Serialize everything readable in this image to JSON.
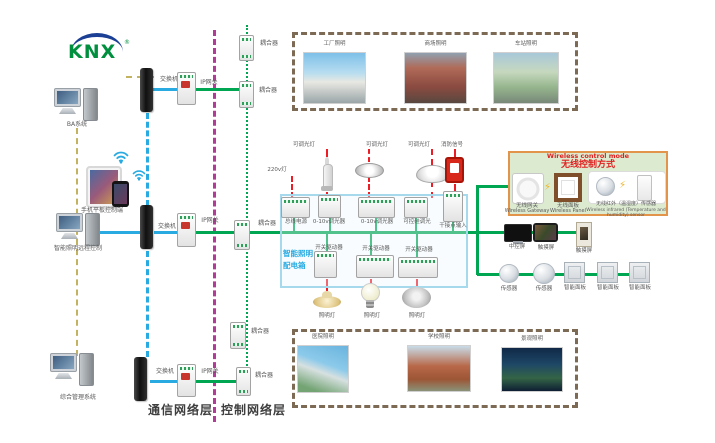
{
  "logo": {
    "text": "KNX",
    "reg": "®"
  },
  "left": {
    "computers": [
      {
        "label": "BA系统"
      },
      {
        "label": "智能照明远程控制"
      },
      {
        "label": "综合管理系统"
      }
    ],
    "mobile_label": "手机平板控制端"
  },
  "network": {
    "switches": [
      "交换机",
      "交换机",
      "交换机"
    ],
    "gateways": [
      "IP网关",
      "IP网关",
      "IP网关"
    ],
    "couplers": [
      "耦合器",
      "耦合器",
      "耦合器",
      "耦合器",
      "耦合器"
    ]
  },
  "layers": {
    "comm": "通信网络层",
    "ctrl": "控制网络层"
  },
  "top_zone": {
    "photos": [
      {
        "label": "工厂照明"
      },
      {
        "label": "商场照明"
      },
      {
        "label": "车站照明"
      }
    ]
  },
  "bottom_zone": {
    "photos": [
      {
        "label": "医院照明"
      },
      {
        "label": "学校照明"
      },
      {
        "label": "景观照明"
      }
    ]
  },
  "panel": {
    "title_line1": "智能照明",
    "title_line2": "配电箱",
    "circuit_labels": {
      "v220": "220v灯",
      "dim1": "可调光灯",
      "dim2": "可调光灯",
      "dim3": "可调光灯",
      "fire": "消防信号"
    },
    "row1": [
      {
        "label": "总线电源"
      },
      {
        "label": "0-10v调光器"
      },
      {
        "label": "0-10v调光器"
      },
      {
        "label": "可控硅调光"
      },
      {
        "label": "干接点输入"
      }
    ],
    "row2": [
      {
        "label": "开关驱动器"
      },
      {
        "label": "开关驱动器"
      },
      {
        "label": "开关驱动器"
      }
    ],
    "lamps": [
      {
        "label": "照明灯"
      },
      {
        "label": "照明灯"
      },
      {
        "label": "照明灯"
      }
    ]
  },
  "wireless": {
    "title_en": "Wireless control mode",
    "title_cn": "无线控制方式",
    "items": [
      {
        "cn": "无线网关",
        "en": "Wireless Gateway"
      },
      {
        "cn": "无线面板",
        "en": "Wireless Panel"
      },
      {
        "cn": "无线红外（温湿度）传感器",
        "en": "Wireless infrared (Temperature and humidity) sensor"
      }
    ]
  },
  "right": {
    "row1": [
      {
        "label": "中控屏"
      },
      {
        "label": "触摸屏"
      },
      {
        "label": "触摸屏"
      }
    ],
    "row2": [
      {
        "label": "传感器"
      },
      {
        "label": "传感器"
      },
      {
        "label": "智能面板"
      },
      {
        "label": "智能面板"
      },
      {
        "label": "智能面板"
      }
    ]
  },
  "colors": {
    "green": "#00a651",
    "blue": "#29abe2",
    "purple": "#b03c96",
    "khaki": "#c3b25f",
    "red": "#ee1c25",
    "panel_blue": "#29abe2",
    "wireless_bg": "#dcead0",
    "wireless_border": "#e2944a"
  }
}
